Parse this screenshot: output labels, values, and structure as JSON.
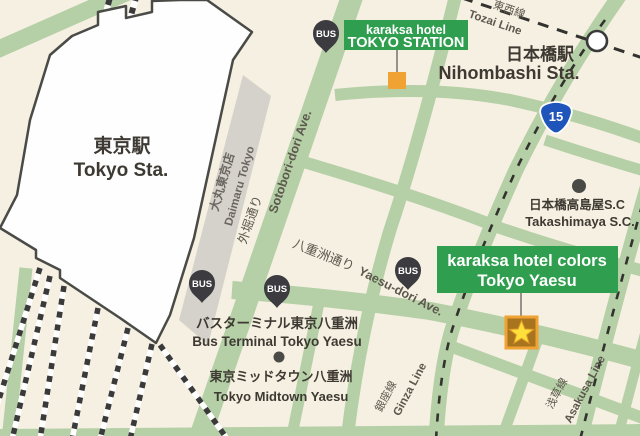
{
  "map_title": "karaksa hotels around Tokyo Station / Yaesu area map",
  "stations": {
    "tokyo_ja": "東京駅",
    "tokyo_en": "Tokyo Sta.",
    "nihombashi_ja": "日本橋駅",
    "nihombashi_en": "Nihombashi Sta."
  },
  "hotel_badges": [
    {
      "line1": "karaksa hotel",
      "line2": "TOKYO STATION",
      "marker": "orange-square"
    },
    {
      "line1": "karaksa hotel colors",
      "line2": "Tokyo Yaesu",
      "marker": "star-square"
    }
  ],
  "streets": {
    "sotobori_ja": "外堀通り",
    "sotobori_en": "Sotobori-dori Ave.",
    "yaesu_ja": "八重洲通り",
    "yaesu_en": "Yaesu-dori Ave."
  },
  "rail_lines": {
    "tozai_ja": "東西線",
    "tozai_en": "Tozai Line",
    "ginza_ja": "銀座線",
    "ginza_en": "Ginza Line",
    "asakusa_ja": "浅草線",
    "asakusa_en": "Asakusa Line"
  },
  "pois": {
    "daimaru_ja": "大丸東京店",
    "daimaru_en": "Daimaru Tokyo",
    "takashimaya_ja": "日本橋高島屋S.C",
    "takashimaya_en": "Takashimaya S.C.",
    "bus_terminal_ja": "バスターミナル東京八重洲",
    "bus_terminal_en": "Bus Terminal Tokyo Yaesu",
    "midtown_ja": "東京ミッドタウン八重洲",
    "midtown_en": "Tokyo Midtown Yaesu"
  },
  "route_shield": {
    "number": "15"
  },
  "bus_stop_label": "BUS",
  "colors": {
    "background": "#f5f0e1",
    "street_green": "#b5cfa6",
    "badge_green": "#2f9e4e",
    "marker_orange": "#f0a232",
    "star_yellow": "#ffdf3a",
    "pin_dark": "#3b3b40",
    "building_gray": "#d5d2cb",
    "building_white": "#fefefe",
    "outline_dark": "#4a4a46",
    "route_blue": "#1f55bb"
  }
}
